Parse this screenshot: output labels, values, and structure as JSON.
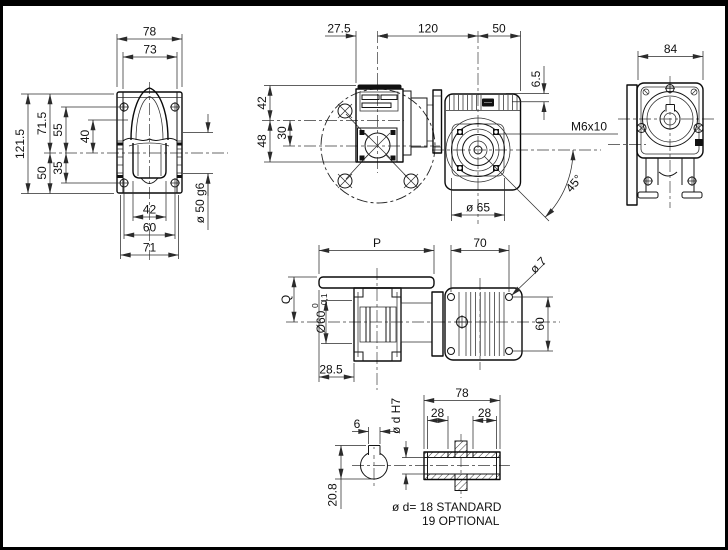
{
  "views": {
    "front": {
      "dim_78": "78",
      "dim_73": "73",
      "dim_121_5": "121.5",
      "dim_71_5": "71.5",
      "dim_55": "55",
      "dim_40": "40",
      "dim_50": "50",
      "dim_35": "35",
      "dim_42": "42",
      "dim_60": "60",
      "dim_71": "71",
      "dim_shaft": "ø 50 g6"
    },
    "top": {
      "dim_27_5": "27.5",
      "dim_120": "120",
      "dim_50": "50",
      "dim_42": "42",
      "dim_30": "30",
      "dim_48": "48",
      "dim_6_5": "6.5",
      "label_thread": "M6x10",
      "dim_angle": "45°",
      "dim_flange": "ø 65"
    },
    "side": {
      "dim_84": "84"
    },
    "flange": {
      "dim_p": "P",
      "dim_70": "70",
      "dim_hole": "ø 7",
      "dim_q": "Q",
      "dim_bore": "Ø60",
      "tol_upper": "0",
      "tol_lower": "-0,1",
      "dim_60": "60",
      "dim_28_5": "28.5"
    },
    "shaft": {
      "dim_6": "6",
      "label_bore": "ø d H7",
      "dim_78": "78",
      "dim_28a": "28",
      "dim_28b": "28",
      "dim_20_8": "20.8",
      "note_line1": "ø d= 18 STANDARD",
      "note_line2": "19 OPTIONAL"
    }
  }
}
